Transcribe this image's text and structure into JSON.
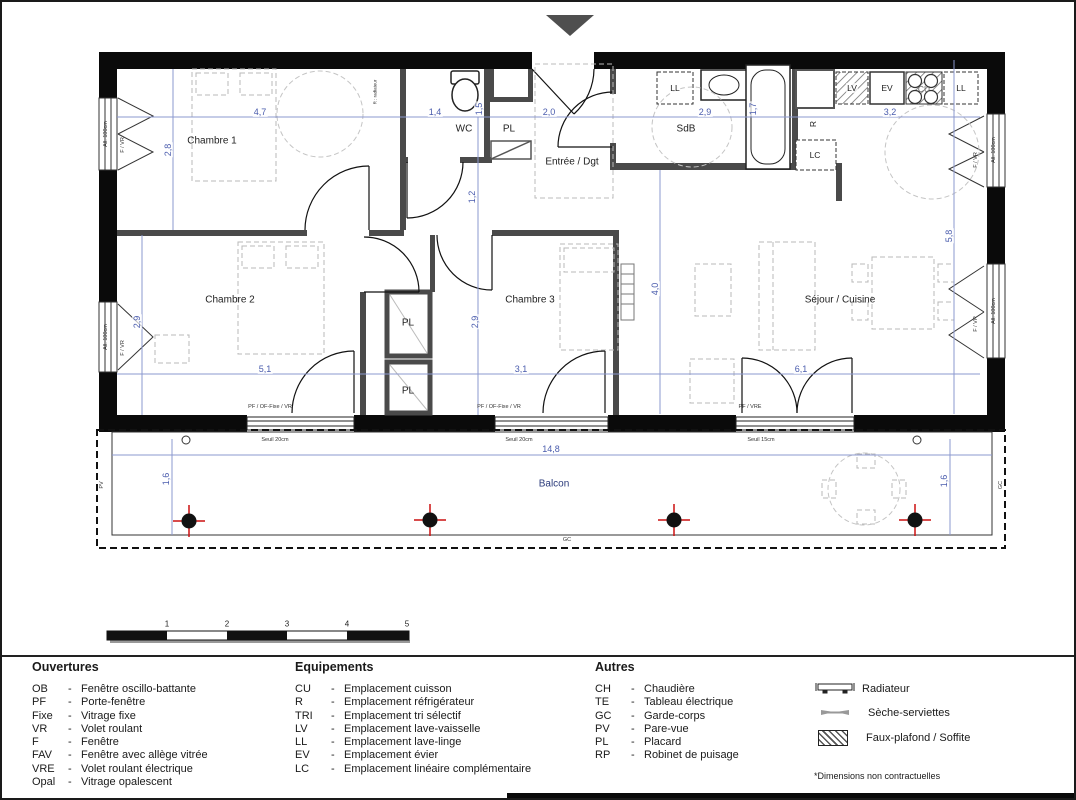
{
  "plan": {
    "rooms": {
      "chambre1": "Chambre 1",
      "wc": "WC",
      "pl": "PL",
      "entree": "Entrée / Dgt",
      "sdb": "SdB",
      "chambre2": "Chambre 2",
      "chambre3": "Chambre 3",
      "sejour": "Séjour / Cuisine",
      "balcon": "Balcon"
    },
    "equipment": {
      "ll": "LL",
      "lv": "LV",
      "ev": "EV",
      "cu": "CU",
      "lc": "LC",
      "r": "R"
    },
    "micro": {
      "gc": "GC",
      "pv": "PV",
      "all100": "All. 100cm",
      "fvr": "F / VR",
      "pf_of_vr": "PF / OF-Fixe / VR",
      "pf_vre": "PF / VRE",
      "seuil20": "Seuil 20cm",
      "seuil15": "Seuil 15cm",
      "note_r": "R : radiateur"
    },
    "dims": [
      "4,7",
      "1,4",
      "1,5",
      "2,0",
      "1,7",
      "2,9",
      "3,2",
      "2,8",
      "1,2",
      "2,9",
      "2,9",
      "4,0",
      "5,8",
      "5,1",
      "3,1",
      "6,1",
      "14,8",
      "1,6",
      "1,6"
    ]
  },
  "scalebar": {
    "ticks": [
      "1",
      "2",
      "3",
      "4",
      "5"
    ]
  },
  "legend": {
    "sep": "-",
    "headers": {
      "ouvertures": "Ouvertures",
      "equipements": "Equipements",
      "autres": "Autres"
    },
    "ouvertures": [
      {
        "a": "OB",
        "d": "Fenêtre oscillo-battante"
      },
      {
        "a": "PF",
        "d": "Porte-fenêtre"
      },
      {
        "a": "Fixe",
        "d": "Vitrage fixe"
      },
      {
        "a": "VR",
        "d": "Volet roulant"
      },
      {
        "a": "F",
        "d": "Fenêtre"
      },
      {
        "a": "FAV",
        "d": "Fenêtre avec allège vitrée"
      },
      {
        "a": "VRE",
        "d": "Volet roulant électrique"
      },
      {
        "a": "Opal",
        "d": "Vitrage opalescent"
      }
    ],
    "equipements": [
      {
        "a": "CU",
        "d": "Emplacement cuisson"
      },
      {
        "a": "R",
        "d": "Emplacement réfrigérateur"
      },
      {
        "a": "TRI",
        "d": "Emplacement tri sélectif"
      },
      {
        "a": "LV",
        "d": "Emplacement lave-vaisselle"
      },
      {
        "a": "LL",
        "d": "Emplacement lave-linge"
      },
      {
        "a": "EV",
        "d": "Emplacement évier"
      },
      {
        "a": "LC",
        "d": "Emplacement linéaire complémentaire"
      }
    ],
    "autres": [
      {
        "a": "CH",
        "d": "Chaudière"
      },
      {
        "a": "TE",
        "d": "Tableau électrique"
      },
      {
        "a": "GC",
        "d": "Garde-corps"
      },
      {
        "a": "PV",
        "d": "Pare-vue"
      },
      {
        "a": "PL",
        "d": "Placard"
      },
      {
        "a": "RP",
        "d": "Robinet de puisage"
      }
    ],
    "symbols": [
      "Radiateur",
      "Sèche-serviettes",
      "Faux-plafond / Soffite"
    ],
    "note": "*Dimensions non contractuelles"
  }
}
